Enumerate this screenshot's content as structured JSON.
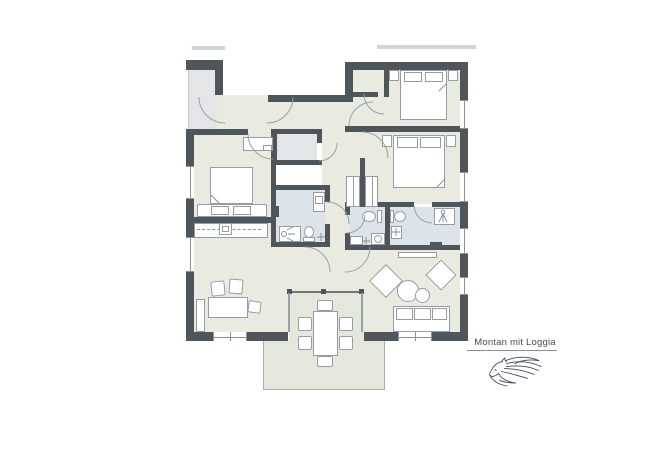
{
  "plan": {
    "label": "Montan mit Loggia"
  },
  "branding": {
    "logo_icon": "horse-logo"
  },
  "icons": {
    "horse-logo": "stylized horse head with flowing mane, line art",
    "shower-icon": "shower head with spray lines",
    "faucet-cross-icon": "plus-shaped tap symbol on washbasin",
    "washing-machine-icon": "square with round door",
    "door-swing-arc": "quarter-circle door swing",
    "stove-icon": "square hob on kitchen counter"
  },
  "colors": {
    "wall": "#4e555b",
    "room": "#e9ebe0",
    "utility": "#e4e5e7",
    "bath": "#dce3ea",
    "loggia": "#e4e7db",
    "outline": "#969da2",
    "arc": "#9aa1a6",
    "text": "#474c51",
    "rule": "#8a9095",
    "stub": "#d2d5d6",
    "fixture": "#8d9298"
  }
}
